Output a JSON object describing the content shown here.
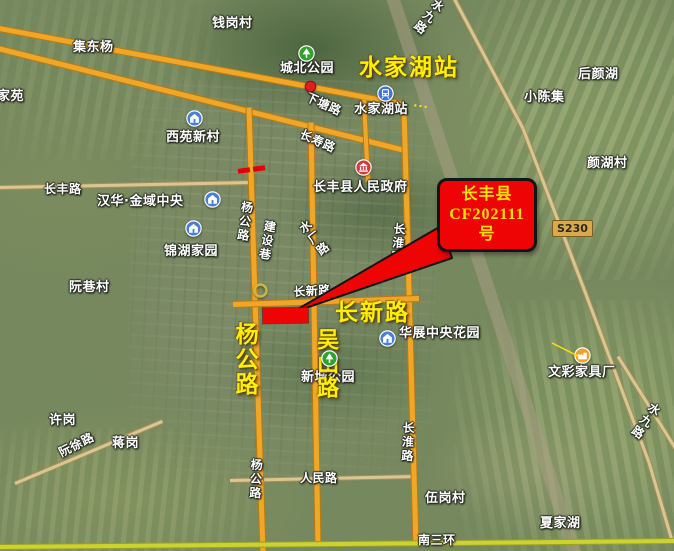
{
  "map": {
    "colors": {
      "main_road": "#f0a728",
      "main_road_border": "#b97a10",
      "ring_road": "#ccd234",
      "ring_road_border": "#9aa21e",
      "minor_road": "#d8c795",
      "minor_road_border": "#a88e55",
      "railway_band": "rgba(168,158,132,0.55)",
      "annotation_red": "#ee0404",
      "highlight_yellow": "#ffee00",
      "callout_text": "#ffe100"
    },
    "callout": {
      "line1": "长丰县",
      "line2": "CF202111",
      "line3": "号"
    },
    "shield": {
      "text": "S230"
    },
    "labels": [
      {
        "t": "钱岗村",
        "x": 212,
        "y": 17,
        "name": "label-qiangangcun"
      },
      {
        "t": "集东杨",
        "x": 73,
        "y": 41,
        "name": "label-jidongyang"
      },
      {
        "t": "家苑",
        "x": -3,
        "y": 90,
        "name": "label-jiayuan"
      },
      {
        "t": "城北公园",
        "x": 280,
        "y": 62,
        "name": "label-chengbei-park"
      },
      {
        "t": "西苑新村",
        "x": 166,
        "y": 131,
        "name": "label-xiyuan-xincun"
      },
      {
        "t": "水家湖站",
        "x": 354,
        "y": 103,
        "name": "label-shuijiahu-station"
      },
      {
        "t": "小陈集",
        "x": 524,
        "y": 91,
        "name": "label-xiaochenji"
      },
      {
        "t": "后颜湖",
        "x": 578,
        "y": 68,
        "name": "label-houyanhu"
      },
      {
        "t": "颜湖村",
        "x": 587,
        "y": 157,
        "name": "label-yanhucun"
      },
      {
        "t": "长丰县人民政府",
        "x": 313,
        "y": 181,
        "name": "label-changfeng-government"
      },
      {
        "t": "长丰路",
        "x": 44,
        "y": 183,
        "cls": "roadname",
        "name": "label-changfeng-road"
      },
      {
        "t": "汉华·金域中央",
        "x": 97,
        "y": 195,
        "name": "label-hanhua-jinyu"
      },
      {
        "t": "锦湖家园",
        "x": 164,
        "y": 245,
        "name": "label-jinhu-jiayuan"
      },
      {
        "t": "阮巷村",
        "x": 69,
        "y": 281,
        "name": "label-ruanxiangcun"
      },
      {
        "t": "华展中央花园",
        "x": 399,
        "y": 327,
        "name": "label-huazhan-garden"
      },
      {
        "t": "新城公园",
        "x": 301,
        "y": 371,
        "name": "label-xincheng-park"
      },
      {
        "t": "文彩家具厂",
        "x": 548,
        "y": 366,
        "name": "label-wencai-factory"
      },
      {
        "t": "许岗",
        "x": 49,
        "y": 414,
        "name": "label-xugang"
      },
      {
        "t": "蒋岗",
        "x": 112,
        "y": 437,
        "name": "label-jianggang"
      },
      {
        "t": "伍岗村",
        "x": 425,
        "y": 492,
        "name": "label-wugangcun"
      },
      {
        "t": "夏家湖",
        "x": 540,
        "y": 517,
        "name": "label-xiajiahu"
      },
      {
        "t": "南三环",
        "x": 418,
        "y": 534,
        "cls": "roadname",
        "name": "label-nansanhuan"
      },
      {
        "t": "人民路",
        "x": 300,
        "y": 472,
        "cls": "roadname",
        "name": "label-renmin-road"
      },
      {
        "t": "长新路",
        "x": 293,
        "y": 286,
        "rot": -3,
        "cls": "roadname",
        "name": "label-changxin-road"
      },
      {
        "t": "下塘路",
        "x": 309,
        "y": 91,
        "rot": 24,
        "cls": "roadname",
        "name": "label-xiatang-road"
      },
      {
        "t": "长寿路",
        "x": 303,
        "y": 128,
        "rot": 24,
        "cls": "roadname",
        "name": "label-changshou-road"
      },
      {
        "t": "阮徐路",
        "x": 57,
        "y": 448,
        "rot": -27,
        "cls": "roadname",
        "name": "label-ruanxu-road"
      },
      {
        "t": "杨公路",
        "x": 241,
        "y": 200,
        "vert": true,
        "rot": 8,
        "cls": "roadname",
        "name": "label-yanggong-road-north"
      },
      {
        "t": "建设巷",
        "x": 264,
        "y": 219,
        "vert": true,
        "rot": 10,
        "cls": "roadname",
        "name": "label-jianshe-lane"
      },
      {
        "t": "水厂路",
        "x": 296,
        "y": 226,
        "vert": true,
        "rot": -38,
        "cls": "roadname",
        "name": "label-shuichang-road"
      },
      {
        "t": "长淮路",
        "x": 393,
        "y": 222,
        "vert": true,
        "rot": 5,
        "cls": "roadname",
        "name": "label-changhuai-road-north"
      },
      {
        "t": "杨公路",
        "x": 250,
        "y": 458,
        "vert": true,
        "rot": 3,
        "cls": "roadname",
        "name": "label-yanggong-road-south"
      },
      {
        "t": "长淮路",
        "x": 402,
        "y": 421,
        "vert": true,
        "rot": 3,
        "cls": "roadname",
        "name": "label-changhuai-road-south"
      },
      {
        "t": "水九路",
        "x": 436,
        "y": -4,
        "vert": true,
        "rot": 38,
        "cls": "roadname",
        "name": "label-shuijiu-road-north"
      },
      {
        "t": "水九路",
        "x": 652,
        "y": 400,
        "vert": true,
        "rot": 35,
        "cls": "roadname",
        "name": "label-shuijiu-road-south"
      },
      {
        "t": "···",
        "x": 414,
        "y": 100,
        "cls": "dots",
        "rot": 8,
        "name": "label-ellipsis-marks"
      }
    ],
    "highlights": [
      {
        "t": "水家湖站",
        "x": 359,
        "y": 56,
        "name": "highlight-shuijiahu-station"
      },
      {
        "t": "长新路",
        "x": 335,
        "y": 301,
        "name": "highlight-changxin-road"
      },
      {
        "t": "杨公路",
        "x": 232,
        "y": 322,
        "vert": true,
        "name": "highlight-yanggong-road"
      },
      {
        "t": "吴山路",
        "x": 314,
        "y": 328,
        "vert": true,
        "size": 22,
        "name": "highlight-wushan-road"
      }
    ],
    "icons": [
      {
        "type": "tree-icon",
        "x": 298,
        "y": 45
      },
      {
        "type": "tree-icon",
        "x": 321,
        "y": 350
      },
      {
        "type": "house-icon",
        "x": 186,
        "y": 110
      },
      {
        "type": "house-icon",
        "x": 204,
        "y": 191
      },
      {
        "type": "house-icon",
        "x": 185,
        "y": 220
      },
      {
        "type": "house-icon",
        "x": 379,
        "y": 330
      },
      {
        "type": "train-icon",
        "x": 377,
        "y": 85
      },
      {
        "type": "government-icon",
        "x": 355,
        "y": 159
      },
      {
        "type": "factory-icon",
        "x": 574,
        "y": 347
      },
      {
        "type": "red-dot",
        "x": 304,
        "y": 80,
        "s": 13
      },
      {
        "type": "junction-ring",
        "x": 252,
        "y": 282
      }
    ],
    "roads": [
      {
        "x1": 391,
        "y1": -8,
        "x2": 576,
        "y2": 556,
        "w": 13,
        "cls": "rail"
      },
      {
        "x1": 0,
        "y1": 187,
        "x2": 252,
        "y2": 182,
        "w": 3,
        "cls": "minor"
      },
      {
        "x1": 230,
        "y1": 480,
        "x2": 417,
        "y2": 476,
        "w": 3,
        "cls": "minor"
      },
      {
        "x1": 452,
        "y1": -6,
        "x2": 523,
        "y2": 128,
        "w": 3,
        "cls": "minor"
      },
      {
        "x1": 523,
        "y1": 128,
        "x2": 583,
        "y2": 286,
        "w": 3,
        "cls": "minor"
      },
      {
        "x1": 583,
        "y1": 286,
        "x2": 649,
        "y2": 462,
        "w": 3,
        "cls": "minor"
      },
      {
        "x1": 649,
        "y1": 462,
        "x2": 672,
        "y2": 540,
        "w": 3,
        "cls": "minor"
      },
      {
        "x1": 15,
        "y1": 483,
        "x2": 162,
        "y2": 421,
        "w": 3,
        "cls": "minor"
      },
      {
        "x1": 618,
        "y1": 356,
        "x2": 678,
        "y2": 452,
        "w": 3,
        "cls": "minor"
      },
      {
        "x1": -6,
        "y1": 27,
        "x2": 404,
        "y2": 104,
        "w": 5
      },
      {
        "x1": -6,
        "y1": 47,
        "x2": 405,
        "y2": 150,
        "w": 5
      },
      {
        "x1": 249,
        "y1": 107,
        "x2": 263,
        "y2": 553,
        "w": 5
      },
      {
        "x1": 311,
        "y1": 122,
        "x2": 318,
        "y2": 546,
        "w": 5
      },
      {
        "x1": 404,
        "y1": 107,
        "x2": 416,
        "y2": 546,
        "w": 5
      },
      {
        "x1": 364,
        "y1": 100,
        "x2": 368,
        "y2": 182,
        "w": 4
      },
      {
        "x1": 233,
        "y1": 304,
        "x2": 419,
        "y2": 298,
        "w": 5
      },
      {
        "x1": -4,
        "y1": 547,
        "x2": 676,
        "y2": 541,
        "w": 4,
        "cls": "ring"
      }
    ],
    "ticks": [
      {
        "x": 238,
        "y": 168
      },
      {
        "x": 253,
        "y": 166
      }
    ],
    "arrow": {
      "points": "291,313 441,226 452,258"
    },
    "leader_line": {
      "x1": 552,
      "y1": 343,
      "x2": 578,
      "y2": 356
    }
  }
}
